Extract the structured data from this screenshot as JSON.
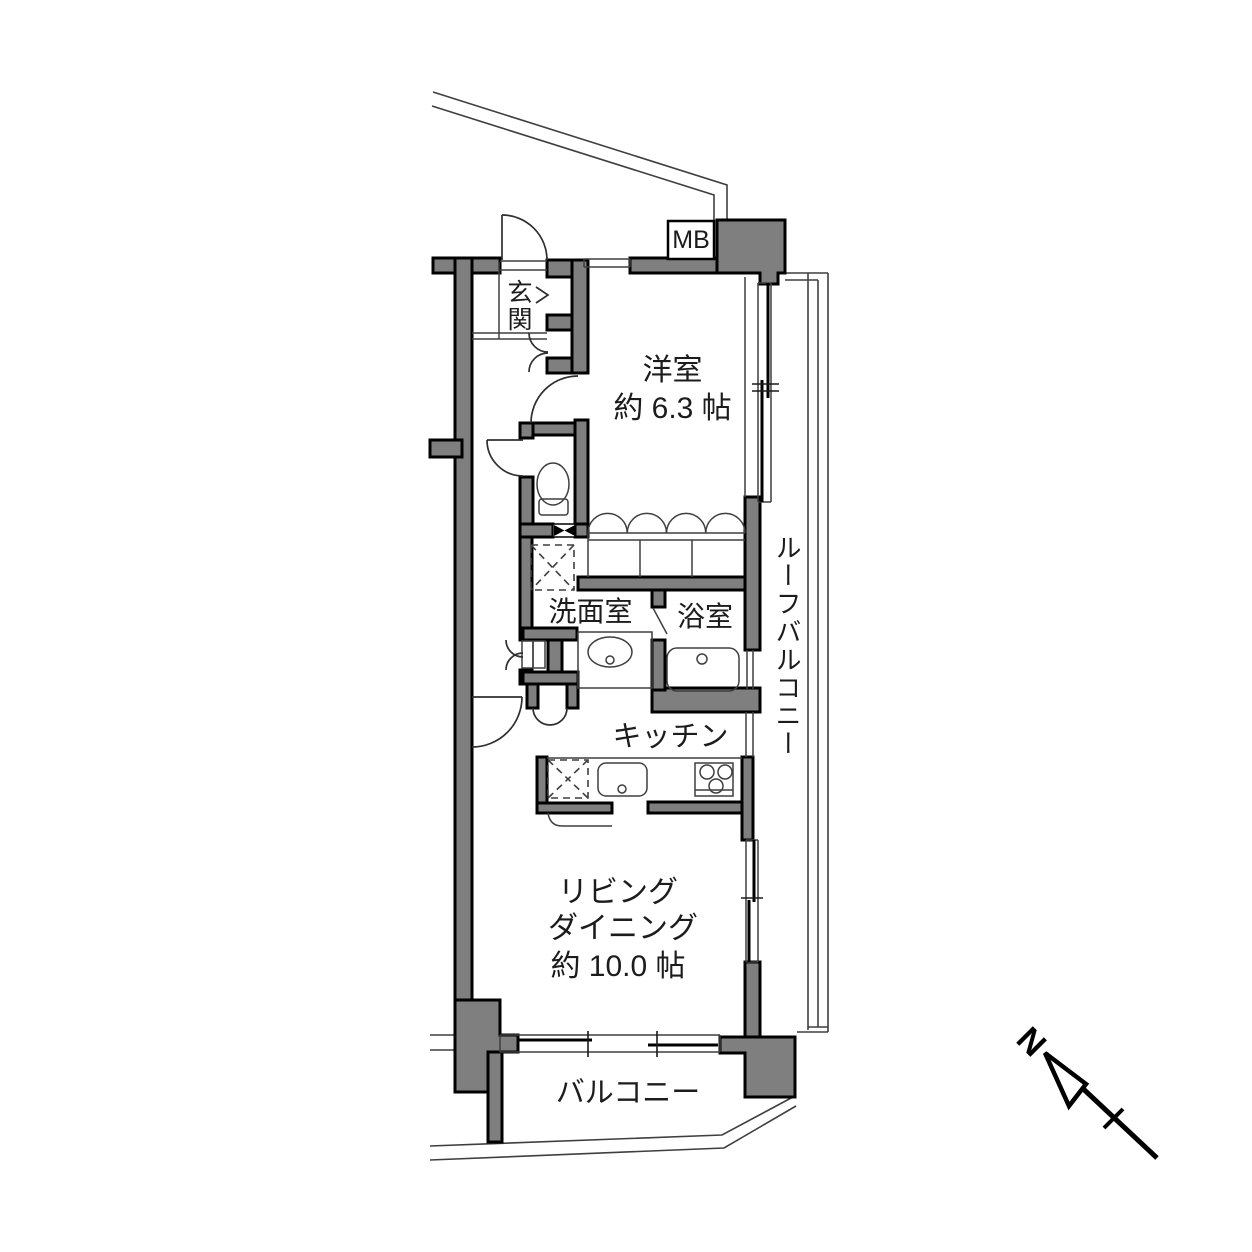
{
  "colors": {
    "background": "#ffffff",
    "wall_fill": "#7f7f7f",
    "wall_outline": "#000000",
    "thin_line": "#3f3f3f"
  },
  "rooms": {
    "entrance": {
      "label": "玄関"
    },
    "meter_box": {
      "label": "MB"
    },
    "western_room": {
      "label": "洋室",
      "size": "約 6.3 帖"
    },
    "roof_balcony": {
      "label": "ルーフバルコニー"
    },
    "washroom": {
      "label": "洗面室"
    },
    "bathroom": {
      "label": "浴室"
    },
    "kitchen": {
      "label": "キッチン"
    },
    "living_dining": {
      "line1": "リビング",
      "line2": "ダイニング",
      "size": "約 10.0 帖"
    },
    "balcony": {
      "label": "バルコニー"
    }
  },
  "compass": {
    "north_label": "N"
  }
}
